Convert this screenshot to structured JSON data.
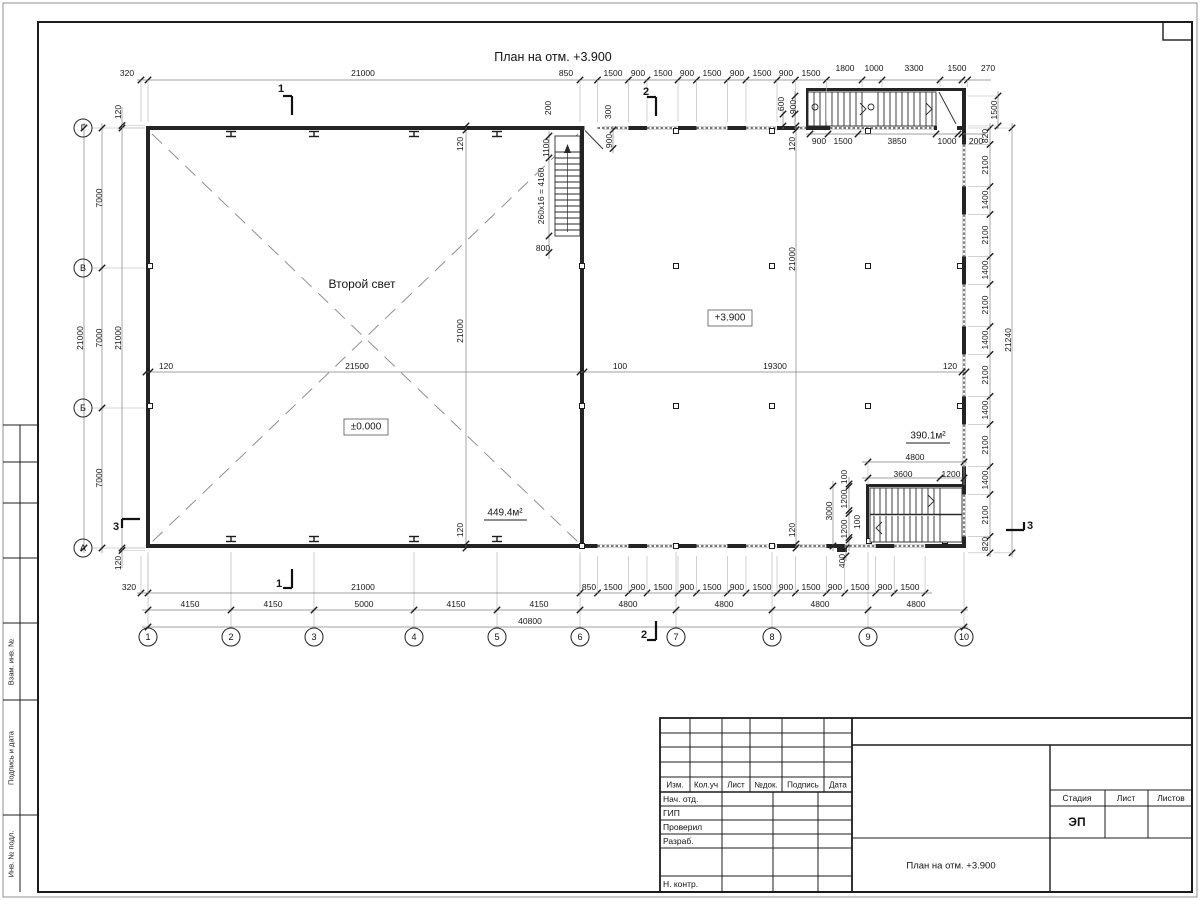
{
  "drawing_title": "План на отм. +3.900",
  "areas": {
    "second_light": {
      "t": "Второй свет",
      "x": 362,
      "y": 284
    },
    "level_zero": {
      "t": "±0.000",
      "x": 366,
      "y": 427
    },
    "level_390": {
      "t": "+3.900",
      "x": 730,
      "y": 318
    },
    "area_left": {
      "t": "449.4м²",
      "x": 505,
      "y": 513
    },
    "area_right": {
      "t": "390.1м²",
      "x": 928,
      "y": 436
    }
  },
  "axes": {
    "bottom": [
      "1",
      "2",
      "3",
      "4",
      "5",
      "6",
      "7",
      "8",
      "9",
      "10"
    ],
    "left": [
      "Г",
      "В",
      "Б",
      "А"
    ]
  },
  "section_marks": [
    {
      "n": "1",
      "x": 281,
      "y": 89
    },
    {
      "n": "1",
      "x": 279,
      "y": 584
    },
    {
      "n": "2",
      "x": 646,
      "y": 92
    },
    {
      "n": "2",
      "x": 644,
      "y": 635
    },
    {
      "n": "3",
      "x": 116,
      "y": 527
    },
    {
      "n": "3",
      "x": 1030,
      "y": 526
    }
  ],
  "dim_labels": [
    {
      "t": "320",
      "x": 127,
      "y": 73
    },
    {
      "t": "21000",
      "x": 363,
      "y": 73
    },
    {
      "t": "850",
      "x": 566,
      "y": 73
    },
    {
      "t": "1500",
      "x": 613,
      "y": 73
    },
    {
      "t": "900",
      "x": 638,
      "y": 73
    },
    {
      "t": "1500",
      "x": 663,
      "y": 73
    },
    {
      "t": "900",
      "x": 687,
      "y": 73
    },
    {
      "t": "1500",
      "x": 712,
      "y": 73
    },
    {
      "t": "900",
      "x": 737,
      "y": 73
    },
    {
      "t": "1500",
      "x": 762,
      "y": 73
    },
    {
      "t": "900",
      "x": 786,
      "y": 73
    },
    {
      "t": "1500",
      "x": 811,
      "y": 73
    },
    {
      "t": "1800",
      "x": 845,
      "y": 68
    },
    {
      "t": "1000",
      "x": 874,
      "y": 68
    },
    {
      "t": "3300",
      "x": 914,
      "y": 68
    },
    {
      "t": "1500",
      "x": 957,
      "y": 68
    },
    {
      "t": "270",
      "x": 988,
      "y": 68
    },
    {
      "t": "200",
      "x": 548,
      "y": 108,
      "r": 1
    },
    {
      "t": "300",
      "x": 608,
      "y": 112,
      "r": 1
    },
    {
      "t": "600",
      "x": 781,
      "y": 104,
      "r": 1
    },
    {
      "t": "900",
      "x": 793,
      "y": 107,
      "r": 1
    },
    {
      "t": "1100",
      "x": 546,
      "y": 148,
      "r": 1
    },
    {
      "t": "260x16 = 4160",
      "x": 541,
      "y": 196,
      "r": 1
    },
    {
      "t": "900",
      "x": 609,
      "y": 141,
      "r": 1
    },
    {
      "t": "800",
      "x": 543,
      "y": 248
    },
    {
      "t": "120",
      "x": 460,
      "y": 144,
      "r": 1
    },
    {
      "t": "120",
      "x": 792,
      "y": 144,
      "r": 1
    },
    {
      "t": "21000",
      "x": 460,
      "y": 331,
      "r": 1
    },
    {
      "t": "21000",
      "x": 792,
      "y": 259,
      "r": 1
    },
    {
      "t": "120",
      "x": 460,
      "y": 530,
      "r": 1
    },
    {
      "t": "120",
      "x": 792,
      "y": 530,
      "r": 1
    },
    {
      "t": "900",
      "x": 819,
      "y": 141
    },
    {
      "t": "1500",
      "x": 843,
      "y": 141
    },
    {
      "t": "3850",
      "x": 897,
      "y": 141
    },
    {
      "t": "1000",
      "x": 947,
      "y": 141
    },
    {
      "t": "200",
      "x": 976,
      "y": 141
    },
    {
      "t": "120",
      "x": 166,
      "y": 366
    },
    {
      "t": "21500",
      "x": 357,
      "y": 366
    },
    {
      "t": "100",
      "x": 620,
      "y": 366
    },
    {
      "t": "19300",
      "x": 775,
      "y": 366
    },
    {
      "t": "120",
      "x": 950,
      "y": 366
    },
    {
      "t": "120",
      "x": 118,
      "y": 112,
      "r": 1
    },
    {
      "t": "21000",
      "x": 118,
      "y": 338,
      "r": 1
    },
    {
      "t": "120",
      "x": 118,
      "y": 563,
      "r": 1
    },
    {
      "t": "7000",
      "x": 99,
      "y": 198,
      "r": 1
    },
    {
      "t": "7000",
      "x": 99,
      "y": 338,
      "r": 1
    },
    {
      "t": "7000",
      "x": 99,
      "y": 478,
      "r": 1
    },
    {
      "t": "21000",
      "x": 80,
      "y": 338,
      "r": 1
    },
    {
      "t": "1500",
      "x": 994,
      "y": 110,
      "r": 1
    },
    {
      "t": "820",
      "x": 985,
      "y": 136,
      "r": 1
    },
    {
      "t": "2100",
      "x": 985,
      "y": 165,
      "r": 1
    },
    {
      "t": "1400",
      "x": 985,
      "y": 200,
      "r": 1
    },
    {
      "t": "2100",
      "x": 985,
      "y": 235,
      "r": 1
    },
    {
      "t": "1400",
      "x": 985,
      "y": 270,
      "r": 1
    },
    {
      "t": "2100",
      "x": 985,
      "y": 305,
      "r": 1
    },
    {
      "t": "1400",
      "x": 985,
      "y": 340,
      "r": 1
    },
    {
      "t": "2100",
      "x": 985,
      "y": 375,
      "r": 1
    },
    {
      "t": "1400",
      "x": 985,
      "y": 410,
      "r": 1
    },
    {
      "t": "2100",
      "x": 985,
      "y": 445,
      "r": 1
    },
    {
      "t": "1400",
      "x": 985,
      "y": 480,
      "r": 1
    },
    {
      "t": "2100",
      "x": 985,
      "y": 515,
      "r": 1
    },
    {
      "t": "820",
      "x": 985,
      "y": 544,
      "r": 1
    },
    {
      "t": "21240",
      "x": 1008,
      "y": 340,
      "r": 1
    },
    {
      "t": "320",
      "x": 129,
      "y": 587
    },
    {
      "t": "21000",
      "x": 363,
      "y": 587
    },
    {
      "t": "850",
      "x": 589,
      "y": 587
    },
    {
      "t": "1500",
      "x": 613,
      "y": 587
    },
    {
      "t": "900",
      "x": 638,
      "y": 587
    },
    {
      "t": "1500",
      "x": 663,
      "y": 587
    },
    {
      "t": "900",
      "x": 687,
      "y": 587
    },
    {
      "t": "1500",
      "x": 712,
      "y": 587
    },
    {
      "t": "900",
      "x": 737,
      "y": 587
    },
    {
      "t": "1500",
      "x": 762,
      "y": 587
    },
    {
      "t": "900",
      "x": 786,
      "y": 587
    },
    {
      "t": "1500",
      "x": 811,
      "y": 587
    },
    {
      "t": "900",
      "x": 835,
      "y": 587
    },
    {
      "t": "1500",
      "x": 860,
      "y": 587
    },
    {
      "t": "900",
      "x": 885,
      "y": 587
    },
    {
      "t": "1500",
      "x": 910,
      "y": 587
    },
    {
      "t": "400",
      "x": 842,
      "y": 561,
      "r": 1
    },
    {
      "t": "4150",
      "x": 190,
      "y": 604
    },
    {
      "t": "4150",
      "x": 273,
      "y": 604
    },
    {
      "t": "5000",
      "x": 364,
      "y": 604
    },
    {
      "t": "4150",
      "x": 456,
      "y": 604
    },
    {
      "t": "4150",
      "x": 539,
      "y": 604
    },
    {
      "t": "4800",
      "x": 628,
      "y": 604
    },
    {
      "t": "4800",
      "x": 724,
      "y": 604
    },
    {
      "t": "4800",
      "x": 820,
      "y": 604
    },
    {
      "t": "4800",
      "x": 916,
      "y": 604
    },
    {
      "t": "40800",
      "x": 530,
      "y": 621
    },
    {
      "t": "4800",
      "x": 915,
      "y": 457
    },
    {
      "t": "3600",
      "x": 903,
      "y": 474
    },
    {
      "t": "1200",
      "x": 951,
      "y": 474
    },
    {
      "t": "3000",
      "x": 829,
      "y": 511,
      "r": 1
    },
    {
      "t": "100",
      "x": 844,
      "y": 477,
      "r": 1
    },
    {
      "t": "1200",
      "x": 844,
      "y": 499,
      "r": 1
    },
    {
      "t": "1200",
      "x": 844,
      "y": 529,
      "r": 1
    },
    {
      "t": "100",
      "x": 857,
      "y": 522,
      "r": 1
    }
  ],
  "geometry": {
    "axis_x": [
      148,
      231,
      314,
      414,
      497,
      580,
      676,
      772,
      868,
      964
    ],
    "axis_y": [
      128,
      268,
      408,
      548
    ],
    "bubble_bottom_y": 637,
    "bubble_left_x": 83,
    "rails_h": [
      {
        "y": 80,
        "x1": 137,
        "x2": 991,
        "ticks": [
          141,
          148,
          580,
          597.5,
          628.4,
          647,
          678,
          696.5,
          727.4,
          746,
          777,
          795.4,
          826.3,
          862,
          882,
          940,
          962,
          967.5
        ],
        "ext": 122,
        "ext2": {
          "from": 845,
          "to": 87
        }
      },
      {
        "y": 134,
        "x1": 806,
        "x2": 986,
        "ticks": [
          810,
          828,
          858,
          936,
          958,
          962
        ]
      },
      {
        "y": 372,
        "x1": 146,
        "x2": 966,
        "ticks": [
          146,
          150,
          580,
          584,
          962,
          966
        ]
      },
      {
        "y": 593,
        "x1": 137,
        "x2": 932,
        "ticks": [
          141,
          148,
          580,
          597.5,
          628.4,
          647,
          678,
          696.5,
          727.4,
          746,
          777,
          795.4,
          826.3,
          844.8,
          875.7,
          894.2,
          925.1
        ],
        "ext": 556
      },
      {
        "y": 610,
        "x1": 142,
        "x2": 968,
        "ticks": [
          148,
          231,
          314,
          414,
          497,
          580,
          676,
          772,
          868,
          964
        ]
      },
      {
        "y": 627,
        "x1": 142,
        "x2": 968,
        "ticks": [
          148,
          964
        ]
      },
      {
        "y": 462,
        "x1": 862,
        "x2": 967,
        "ticks": [
          868,
          964
        ],
        "ext": 485
      },
      {
        "y": 478,
        "x1": 862,
        "x2": 967,
        "ticks": [
          868,
          940,
          964
        ]
      }
    ],
    "rails_v": [
      {
        "x": 122,
        "y1": 107,
        "y2": 568,
        "ticks": [
          125.5,
          128,
          548,
          550.5
        ],
        "ext": 145
      },
      {
        "x": 102,
        "y1": 123,
        "y2": 553,
        "ticks": [
          128,
          268,
          408,
          548
        ]
      },
      {
        "x": 84,
        "y1": 123,
        "y2": 553,
        "ticks": [
          128,
          548
        ]
      },
      {
        "x": 990,
        "y1": 123,
        "y2": 557,
        "ticks": [
          128,
          144.4,
          186.4,
          214.4,
          256.4,
          284.4,
          326.4,
          354.4,
          396.4,
          424.4,
          466.4,
          494.4,
          536.4,
          552.8
        ],
        "ext": 968
      },
      {
        "x": 1012,
        "y1": 123,
        "y2": 557,
        "ticks": [
          128,
          552.8
        ],
        "ext": 994
      },
      {
        "x": 998,
        "y1": 91,
        "y2": 129,
        "ticks": [
          96,
          126
        ],
        "ext": 968
      },
      {
        "x": 466,
        "y1": 125,
        "y2": 549,
        "ticks": [
          126,
          130,
          544,
          548
        ]
      },
      {
        "x": 796,
        "y1": 125,
        "y2": 549,
        "ticks": [
          126,
          130,
          544,
          548
        ]
      },
      {
        "x": 613,
        "y1": 126,
        "y2": 153,
        "ticks": [
          130,
          148.5
        ]
      },
      {
        "x": 549,
        "y1": 131,
        "y2": 259,
        "ticks": [
          136,
          158,
          236,
          252.5
        ]
      },
      {
        "x": 783,
        "y1": 109,
        "y2": 129,
        "ticks": [
          114,
          126
        ]
      },
      {
        "x": 795,
        "y1": 91,
        "y2": 129,
        "ticks": [
          96,
          114
        ]
      },
      {
        "x": 833,
        "y1": 481,
        "y2": 551,
        "ticks": [
          486,
          546
        ]
      },
      {
        "x": 849,
        "y1": 477,
        "y2": 551,
        "ticks": [
          484,
          486.5,
          510.5,
          513.5,
          537.5,
          540
        ]
      },
      {
        "x": 846,
        "y1": 545,
        "y2": 561,
        "ticks": [
          548,
          556
        ]
      }
    ]
  },
  "side_strip": {
    "labels": [
      "Взам. инв. №",
      "Подпись и дата",
      "Инв. № подл."
    ],
    "boxes": [
      [
        623,
        700
      ],
      [
        700,
        815
      ],
      [
        815,
        892
      ]
    ],
    "empty_boxes": [
      [
        425,
        462
      ],
      [
        462,
        503
      ],
      [
        503,
        558
      ],
      [
        558,
        623
      ]
    ]
  },
  "stamp": {
    "doc_title": "План на отм. +3.900",
    "stage_value": "ЭП",
    "header_cols": [
      {
        "t": "Изм.",
        "x": 675
      },
      {
        "t": "Кол.уч",
        "x": 706
      },
      {
        "t": "Лист",
        "x": 736
      },
      {
        "t": "№док.",
        "x": 766
      },
      {
        "t": "Подпись",
        "x": 803
      },
      {
        "t": "Дата",
        "x": 838
      }
    ],
    "rows": [
      {
        "t": "Нач. отд.",
        "y": 799
      },
      {
        "t": "ГИП",
        "y": 813
      },
      {
        "t": "Проверил",
        "y": 827
      },
      {
        "t": "Разраб.",
        "y": 841
      },
      {
        "t": "Н. контр.",
        "y": 884
      }
    ],
    "right_cols": [
      {
        "t": "Стадия",
        "x": 1077
      },
      {
        "t": "Лист",
        "x": 1126
      },
      {
        "t": "Листов",
        "x": 1171
      }
    ]
  }
}
